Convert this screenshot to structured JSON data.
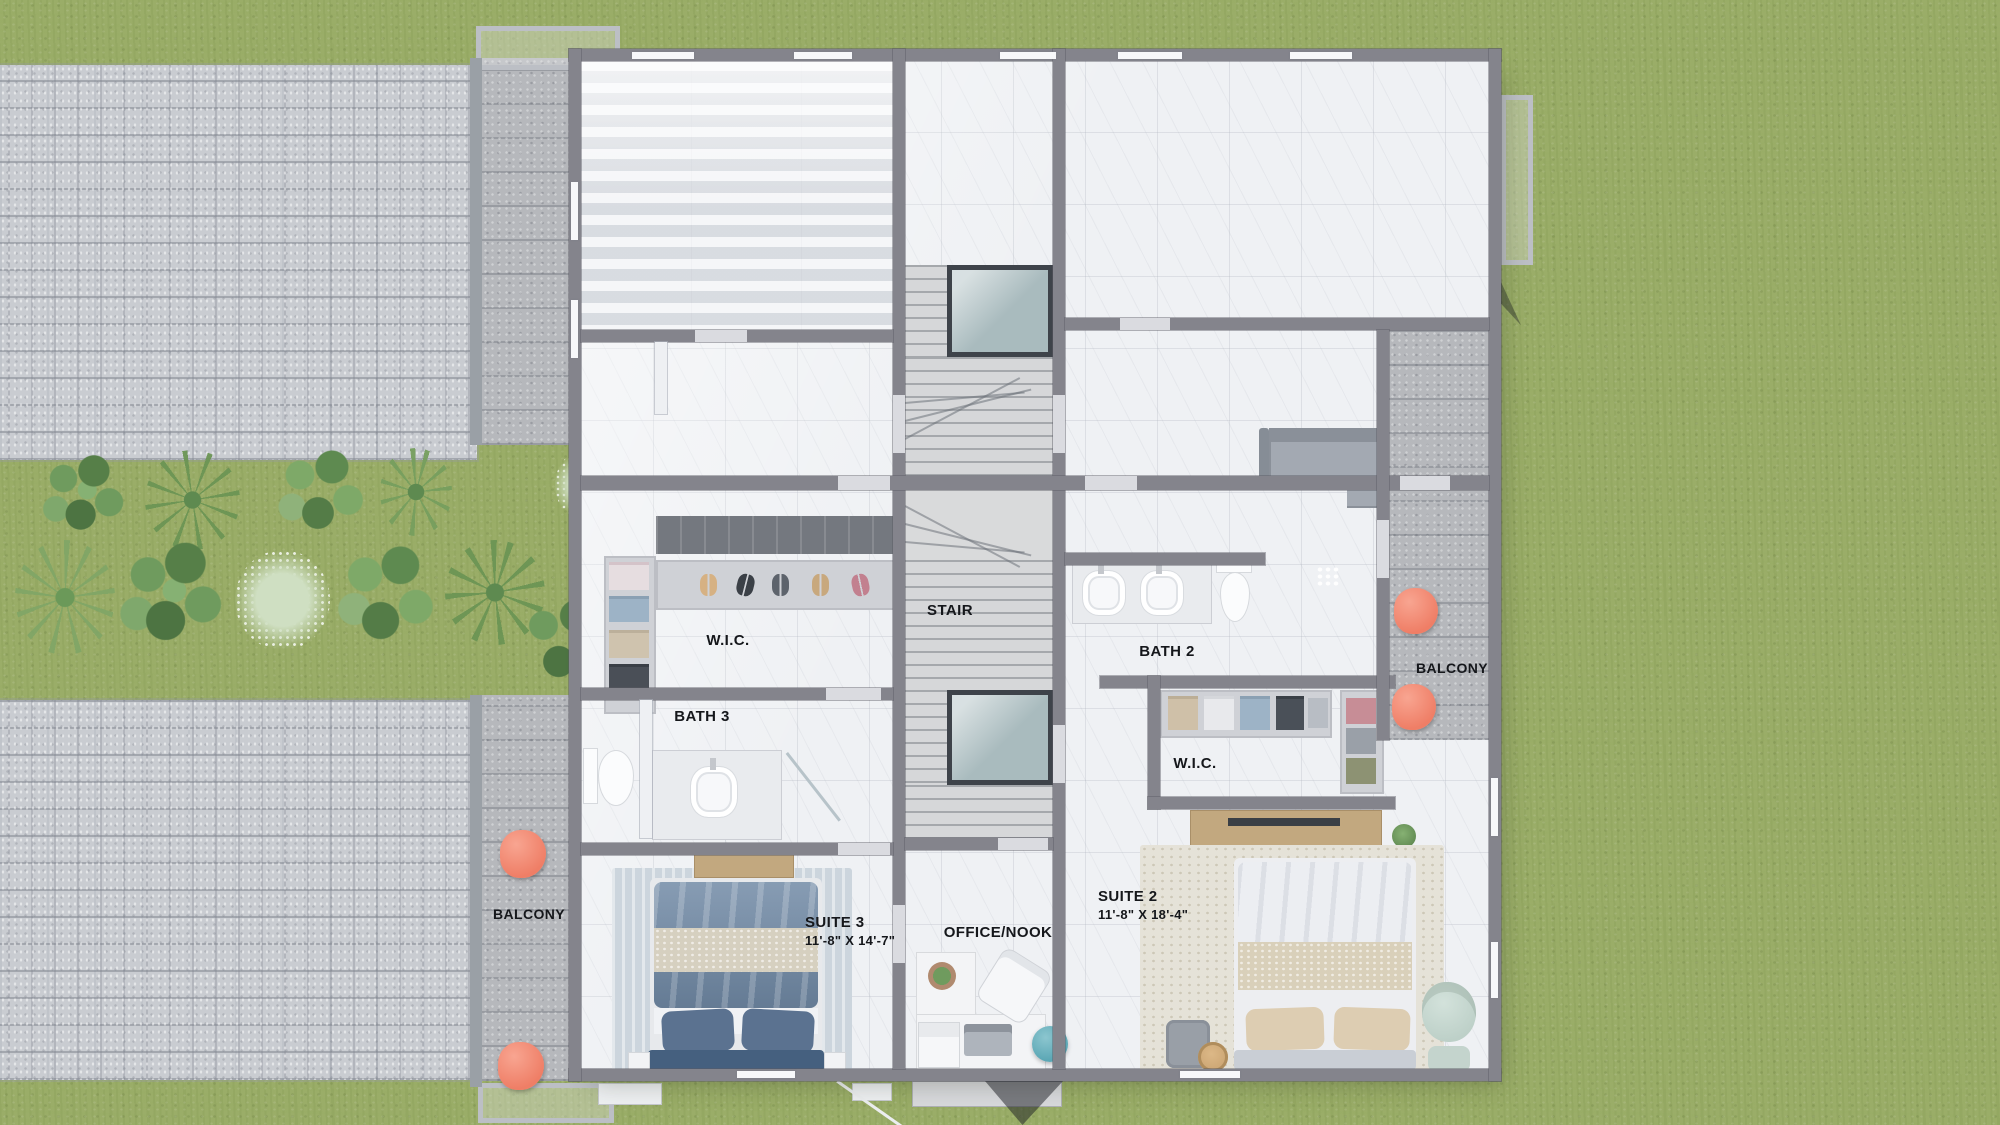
{
  "rooms": [
    {
      "id": "wic_left",
      "label": "W.I.C."
    },
    {
      "id": "bath3",
      "label": "BATH 3"
    },
    {
      "id": "suite3",
      "label": "SUITE 3",
      "dims": "11'-8\" X 14'-7\""
    },
    {
      "id": "office_nook",
      "label": "OFFICE/NOOK"
    },
    {
      "id": "stair",
      "label": "STAIR"
    },
    {
      "id": "bath2",
      "label": "BATH 2"
    },
    {
      "id": "wic_right",
      "label": "W.I.C."
    },
    {
      "id": "suite2",
      "label": "SUITE 2",
      "dims": "11'-8\" X 18'-4\""
    },
    {
      "id": "balcony_left",
      "label": "BALCONY"
    },
    {
      "id": "balcony_right",
      "label": "BALCONY"
    }
  ],
  "colors": {
    "grass": "#9aad68",
    "pavers": "#c9ccd1",
    "deck_concrete": "#b6b8bc",
    "walls": "#84848c",
    "marble_floor": "#eff1f4",
    "stair_glass": "#a9bbbe",
    "accent_coral_chair": "#ef7e66",
    "bed_blue": "#7089a5",
    "knit_cream": "#d6d0c0",
    "teal_pouf": "#5ba7b5",
    "wood": "#c2a87f",
    "sage_chair": "#bdd0c8",
    "label_text": "#15171b"
  }
}
